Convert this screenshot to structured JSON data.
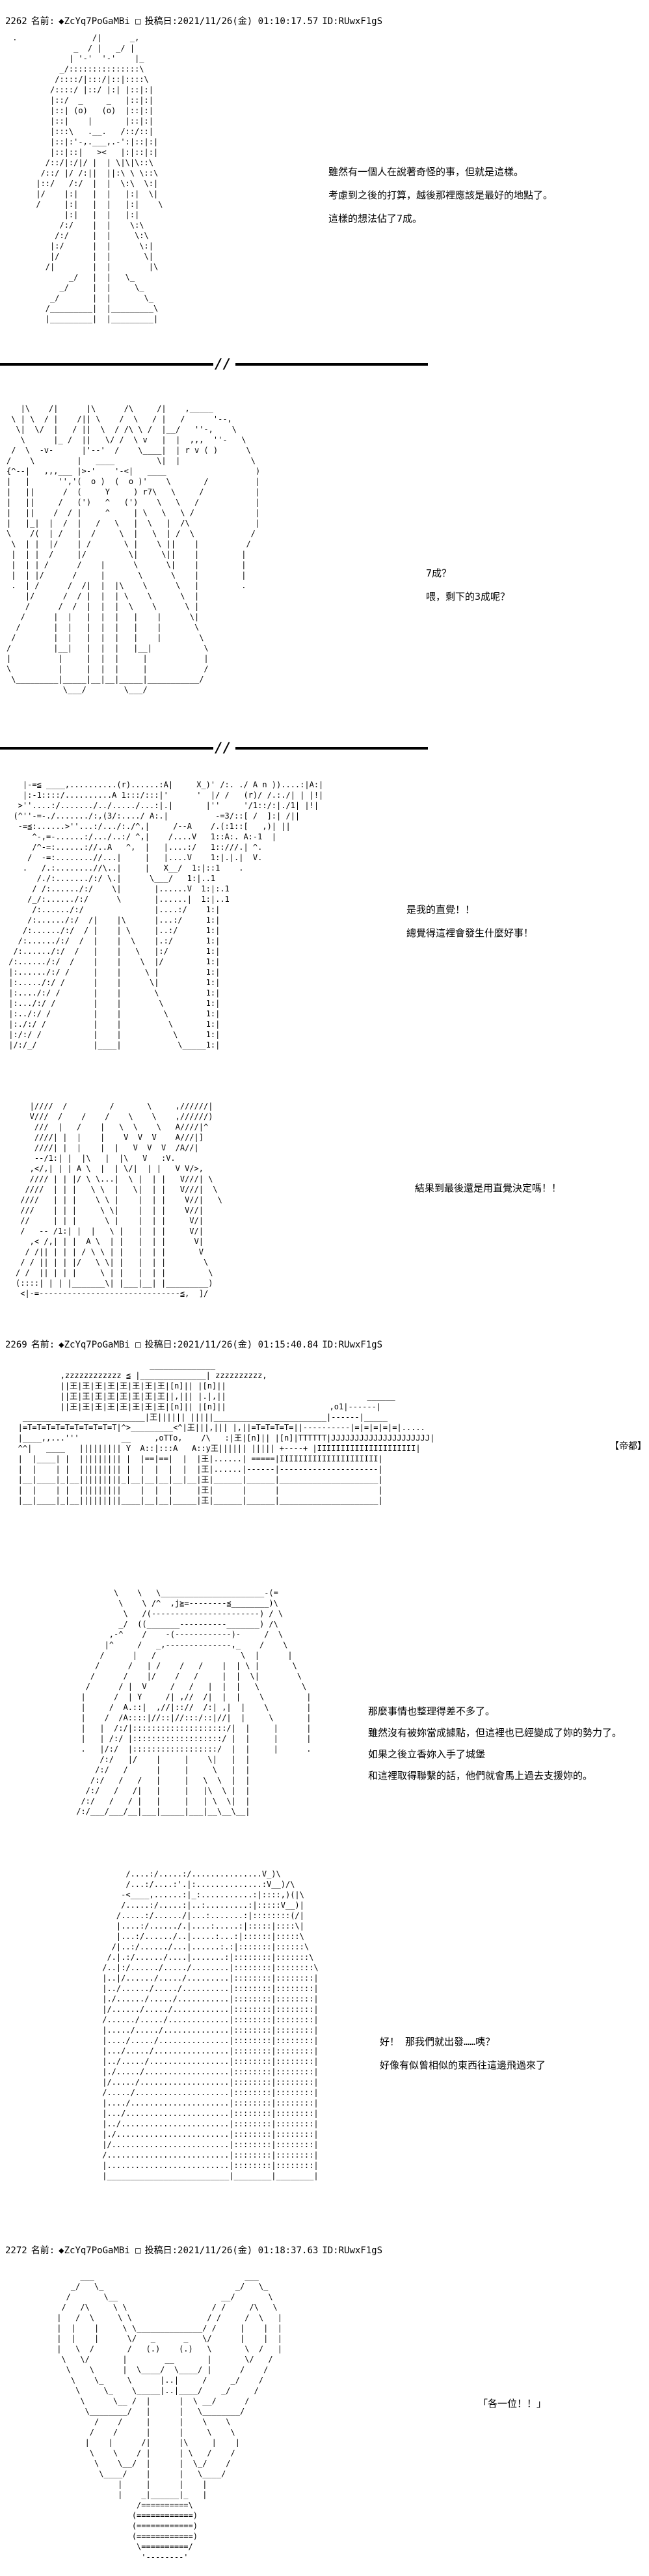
{
  "labels": {
    "name_label": "名前:",
    "date_label": "投稿日:"
  },
  "posts": [
    {
      "number": "2262",
      "name": "◆ZcYq7PoGaMBi □",
      "datetime": "2021/11/26(金) 01:10:17.57",
      "id": "ID:RUwxF1gS"
    },
    {
      "number": "2269",
      "name": "◆ZcYq7PoGaMBi □",
      "datetime": "2021/11/26(金) 01:15:40.84",
      "id": "ID:RUwxF1gS"
    },
    {
      "number": "2272",
      "name": "◆ZcYq7PoGaMBi □",
      "datetime": "2021/11/26(金) 01:18:37.63",
      "id": "ID:RUwxF1gS"
    }
  ],
  "dialogue": {
    "speech1": "雖然有一個人在說著奇怪的事，但就是這樣。\n考慮到之後的打算，越後那裡應該是最好的地點了。\n這樣的想法佔了7成。",
    "speech2": "7成？\n喂，剩下的3成呢？",
    "speech3": "是我的直覺！！\n總覺得這裡會發生什麼好事！",
    "speech4": "結果到最後還是用直覺決定嗎！！",
    "speech5": "那麼事情也整理得差不多了。\n雖然沒有被妳當成據點，但這裡也已經變成了妳的勢力了。\n如果之後立香妳入手了城堡\n和這裡取得聯繫的話，他們就會馬上過去支援妳的。",
    "speech6": "好！ 那我們就出發……咦？\n好像有似曾相似的東西往這邊飛過來了",
    "speech7": "「各一位！！」",
    "city_label": "【帝都】"
  },
  "divider": {
    "slashes": "//"
  },
  "art": {
    "aa1": [
      " .                /|      _,",
      "              _  / |   _/ |",
      "             | '-'  '-'    |_",
      "           _/:::::::::::::::\\",
      "          /::::/|:::/|::|::::\\",
      "         /::::/ |::/ |:| |::|:|",
      "         |::/  _     _   |::|:|",
      "         |::| (o)   (o)  |::|:|",
      "         |::|    |       |::|:|",
      "         |:::\\   .__.   /::/::|",
      "         |::|:'-,.___,.-':|::|:|",
      "         |::|::|   ><   |:|::|:|",
      "        /::/|:/|/ |  | \\|\\|\\::\\",
      "       /::/ |/ /:||  ||:\\ \\ \\::\\",
      "      |::/   /:/  |  |  \\:\\  \\:|",
      "      |/    |:|   |  |   |:|  \\|",
      "      /     |:|   |  |   |:|    \\",
      "            |:|   |  |   |:|",
      "           /:/    |  |    \\:\\",
      "          /:/     |  |     \\:\\",
      "         |:/      |  |      \\:|",
      "         |/       |  |       \\|",
      "        /|        |  |        |\\",
      "             _/   |  |   \\_",
      "           _/     |  |     \\_",
      "         _/       |  |       \\_",
      "        /_________|  |_________\\",
      "        |_________|  |_________|"
    ],
    "aa2": [
      "   |\\    /|      |\\      /\\     /|    ,_____",
      " \\ | \\  / |    /|| \\    /  \\   / |   /      '--,",
      "  \\|  \\/  |   / ||  \\  / /\\ \\ /  |__/   ''-,    \\",
      "   \\      |_ /  ||   \\/ /  \\ v   |  |  ,,,  ''-   \\",
      " /  \\  -v-      |'--'  /    \\____|  | r v ( )      \\",
      "/    \\         |   ____         \\|  |               \\",
      "{^--|   ,,,___ |>-'    '-<|   ____                   )",
      "|   |      '','(  o )  (  o )'    \\       /          |",
      "|   ||      /  (     Y     ) r7\\   \\     /           |",
      "|   ||     /   (')   ^   (')    \\   \\   /            |",
      "|   ||    /  / |     ^     | \\   \\   \\ /             |",
      "|   |_|  |  /  |   /   \\   |  \\   |  /\\              |",
      "\\    /(  | /   |  /     \\  |   \\  | /  \\            /",
      " \\  | |  |/    | /       \\ |    \\ ||    |          /",
      " |  | |  /     |/         \\|     \\||    |         |",
      " |  | | /      /    |      \\      \\|    |         |",
      " |  | |/      /     |       \\      \\    |         |",
      " .  | /      /  /|  |  |\\    \\      \\   |         .",
      "    |/      /  / |  |  | \\    \\      \\  |",
      "    /      /  /  |  |  |  \\    \\      \\ |",
      "   /      |  |   |  |  |   |    |      \\|",
      "  /       |  |   |  |  |   |    |       \\",
      " /        |  |   |  |  |   |    |        \\",
      "/         |__|   |  |  |   |__|           \\",
      "|          |     |  |  |     |            |",
      "\\          |     |  |  |     |            /",
      " \\_________|_____|__|__|_____|___________/",
      "            \\___/        \\___/"
    ],
    "aa3": [
      "    |-=≦ ____,..........(r)......:A|     X_)' /:. ./ A n ))....:|A:|",
      "    |:-1::::/..........A 1:::/:::|'      '  |/ /   (r)/ /.:./| | |!|",
      "   >''....:/......./../...../...:|.|       |''     '/1::/:|./1| |!|",
      "  (^''-=-./......./:,(3/:..../ A:.|          -=3/::[ /  ]:| /||",
      "   -=≦:......>''...:/.../:./^,|     /--A    /.(:1::[   ,)| ||",
      "      ^-,=-......:/.../..:/ ^,|    /....V   1::A:. A:-1  |",
      "      /^-=:......://..A   ^,  |   |....:/   1::///.| ^.",
      "     /  -=:........//...|     |   |....V    1:|.|.|  V.",
      "    .   /.:........//\\..|     |   X__/  1:|::1    .",
      "       /./:......./:/ \\.|      \\___/   1:|..1",
      "      / /:....../:/    \\|       |......V  1:|:.1",
      "     /_/:....../:/      \\       |......|  1:|..1",
      "      /:....../:/               |....:/    1:|",
      "     /:....../:/  /|    |\\      |...:/     1:|",
      "    /:....../:/  / |    | \\     |..:/      1:|",
      "   /:....../:/  /  |    |  \\    |.:/       1:|",
      "  /:....../:/  /   |    |   \\   |:/        1:|",
      " /:....../:/  /    |    |    \\  |/         1:|",
      " |:....../:/ /     |    |     \\ |          1:|",
      " |:...../:/ /      |    |      \\|          1:|",
      " |:..../:/ /       |    |       \\          1:|",
      " |:.../:/ /        |    |        \\         1:|",
      " |:../:/ /         |    |         \\        1:|",
      " |:./:/ /          |    |          \\       1:|",
      " |:/:/ /           |    |           \\      1:|",
      " |/:/_/            |____|            \\_____1:|"
    ],
    "aa4": [
      "   |////  /         /       \\     ,//////|",
      "   V///  /    /    /    \\    \\    ,//////)",
      "    ///  |   /    |   \\  \\    \\   A////|^",
      "    ////| |  |    |    V  V  V    A///|]",
      "    ////| |  |    |  |   V  V  V  /A//|",
      "    --/1:| |  |\\   |  |\\   V   :V.",
      "   ,</,| | | A \\  |  | \\/|  | |   V V/>,",
      "   //// | | |/ \\ \\...|  \\ |  | |   V///| \\",
      "  ////  | | |   \\ \\  |   \\|  | |   V///|  \\",
      " ////   | | |    \\ \\ |    |  | |    V//|   \\",
      " ///    | | |     \\ \\|    |  | |    V//|",
      " //     | | |      \\ |    |  | |     V/|",
      " /   -- /1:| |  |   \\ |   |  | |     V/|",
      "   ,< /,| | |  A \\  | |   |  | |      V|",
      "  / /|| | | | / \\ \\ | |   |  | |       V",
      " / / || | | |/   \\ \\| |   |  | |        \\",
      "/ /  || | | |     \\ | |   |  | |         \\",
      "(::::| | | |_______\\| |___|__| |_________)",
      " <|-=------------------------------≦,  ]/"
    ],
    "city": [
      "                               ______________",
      "            ,zzzzzzzzzzzz ≦ |______________| zzzzzzzzzz,",
      "            ||王|王|王|王|王|王|王|王|[n]|| |[n]||",
      "            ||王|王|王|王|王|王|王|王||,||| |.|,||                              ______",
      "            ||王|王|王|王|王|王|王|王|[n]|| |[n]||                      ,o1|------|",
      "    __________________________|王|||||| |||||________________________|------|_____",
      "   |=T=T=T=T=T=T=T=T=T=T|^>_________<^|王|||,||| |,||=T=T=T=T=||----------|=|=|=|=|=|.....",
      "   |____,,...'''         __     ,oTTo,    /\\   :|王|[n]|| |[n]|TTTTTT|JJJJJJJJJJJJJJJJJJJJJ|",
      "   ^^|   ____   ||||||||| Y  A::|:::A   A::y王|||||| ||||| +----+ |IIIIIIIIIIIIIIIIIIIII|",
      "   |  |____| |  ||||||||| |  |==|==|  |  |王|......| =====|IIIIIIIIIIIIIIIIIIIII|",
      "   |  |    | |  ||||||||| |  |  |  |  |  |王|......|------|---------------------|",
      "   |__|____|_|__|||||||||_|__|__|__|__|__|王|______|______|_____________________|",
      "   |  |    | |  |||||||||    |  |  |     |王|      |      |                     |",
      "   |__|____|_|__|||||||||____|__|__|_____|王|______|______|_____________________|"
    ],
    "aa5": [
      "         \\    \\   \\______________________-(=",
      "          \\    \\ /^  ,j≧=--------≦________)\\",
      "           \\   /(-----------------------) / \\",
      "          _/  ((_______----------_______) /\\",
      "        ,-^    /    -(------------)-     /  \\",
      "       |^     /   _,--------------,_    /    \\",
      "      /      |   /                  \\  |      |",
      "     /      /   | /    /   /    |  | \\ |       \\",
      "    /      /    |/    /   /     |  |  \\|        \\",
      "   /      / |  V     /   /   |  |  |   \\         \\",
      "  |      /  | Y     /| ,//  /|  |  |    \\         |",
      "  |     /  A.::|  ,//|:://  /:| ,|  |    \\        |",
      "  |    /  /A::::|//::|//:::/::|//|  |     \\       |",
      "  |   |  /:/|::::::::::::::::::::/|  |     |      |",
      "  |   | /:/ |:::::::::::::::::::/ |  |     |      |",
      "  .   |/:/  |::::::::::::::::::/  |  |     |      .",
      "      /:/   |/    |     |    \\|   |  |",
      "     /:/   /      |     |     \\   |  |",
      "    /:/   /   /   |     |   \\  \\  |  |",
      "   /:/   /   /|   |     |   |\\  \\ |  |",
      "  /:/   /   / |   |     |   | \\  \\|  |",
      " /:/___/___/__|___|_____|___|__\\__\\__|"
    ],
    "aa6": [
      "      /....:/.....:/...............V_)\\",
      "      /...:/....:'.|:..............:V__)/\\",
      "     -<____,......:|_:...........:|::::,)(|\\",
      "     /.....:/.....:|..:.........:|:::::V__)|",
      "    /.....:/....../|...:.......:|::::::::(/|",
      "    |....:/....../.|....:.....:|:::::|::::\\|",
      "    |...:/....../..|.....:...:|::::::|:::::\\",
      "   /|..:/....../...|......:.:|:::::::|::::::\\",
      "  /.|.:/....../....|.......:|::::::::|:::::::\\",
      " /..|:/....../...../........|::::::::|::::::::\\",
      " |..|/....../...../.........|::::::::|::::::::|",
      " |../....../...../..........|::::::::|::::::::|",
      " |./....../...../...........|::::::::|::::::::|",
      " |/....../...../............|::::::::|::::::::|",
      " /....../...../.............|::::::::|::::::::|",
      " |...../...../..............|::::::::|::::::::|",
      " |..../...../...............|::::::::|::::::::|",
      " |.../...../................|::::::::|::::::::|",
      " |../...../.................|::::::::|::::::::|",
      " |./...../..................|::::::::|::::::::|",
      " |/...../...................|::::::::|::::::::|",
      " /...../....................|::::::::|::::::::|",
      " |..../.....................|::::::::|::::::::|",
      " |.../......................|::::::::|::::::::|",
      " |../.......................|::::::::|::::::::|",
      " |./........................|::::::::|::::::::|",
      " |/.........................|::::::::|::::::::|",
      " /..........................|::::::::|::::::::|",
      " |..........................|::::::::|::::::::|",
      " |__________________________|________|________|"
    ],
    "aa7": [
      "      ___                                ___",
      "    _/   \\_                            _/   \\_",
      "   /       \\__                      __/       \\",
      "  /   /\\     \\ \\                  / /     /\\   \\",
      " |   /  \\     \\ \\                / /     /  \\   |",
      " |  |    |     \\ \\______________/ /     |    |  |",
      " |  |    |      \\/   _      _   \\/      |    |  |",
      " |   \\  /       /   (.)    (.)   \\       \\  /   |",
      "  \\   \\/       |        __       |       \\/   /",
      "   \\    \\      |  \\____/  \\____/ |      /    /",
      "    \\    \\_     \\      |..|     /     _/    /",
      "     \\     \\_    \\_____|..|____/    _/     /",
      "      \\      \\__ /  |      |  \\ __/      /",
      "       \\________/   |      |   \\________/",
      "         /    /     |      |    \\    \\",
      "        /    /      |      |     \\    \\",
      "       |    |      /|      |\\     |    |",
      "        \\    \\    / |      | \\   /    /",
      "         \\    \\__/  |      |  \\_/    /",
      "          \\____/    |      |   \\____/",
      "              |     |      |    |",
      "              |    _|______|_   |",
      "                  /==========\\",
      "                 (============)",
      "                 (============)",
      "                 (============)",
      "                  \\==========/",
      "                   '--------'"
    ]
  }
}
